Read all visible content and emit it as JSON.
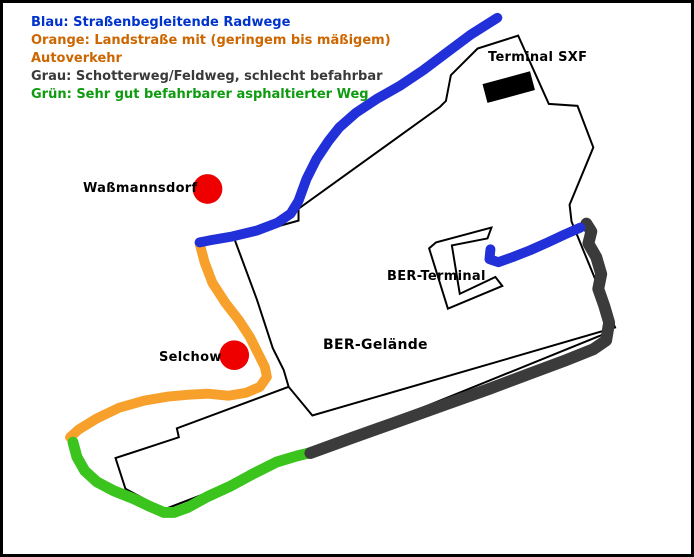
{
  "legend": {
    "lines": [
      {
        "text": "Blau: Straßenbegleitende Radwege",
        "color": "#0033cc"
      },
      {
        "text": "Orange: Landstraße mit (geringem bis mäßigem)",
        "color": "#cc6600"
      },
      {
        "text": "Autoverkehr",
        "color": "#cc6600"
      },
      {
        "text": "Grau: Schotterweg/Feldweg, schlecht befahrbar",
        "color": "#3a3a3a"
      },
      {
        "text": "Grün: Sehr gut befahrbarer asphaltierter Weg",
        "color": "#0f9b0f"
      }
    ]
  },
  "map": {
    "labels": {
      "wassmannsdorf": "Waßmannsdorf",
      "selchow": "Selchow",
      "terminal_sxf": "Terminal SXF",
      "ber_terminal": "BER-Terminal",
      "ber_gelaende": "BER-Gelände"
    },
    "route_colors": {
      "blue_radweg": "#2130d9",
      "orange_landstrasse": "#f7a02b",
      "gray_schotterweg": "#3b3b3b",
      "green_asphaltweg": "#3cc41e"
    },
    "town_marker_color": "#ee0000",
    "outline_color": "#000000"
  }
}
